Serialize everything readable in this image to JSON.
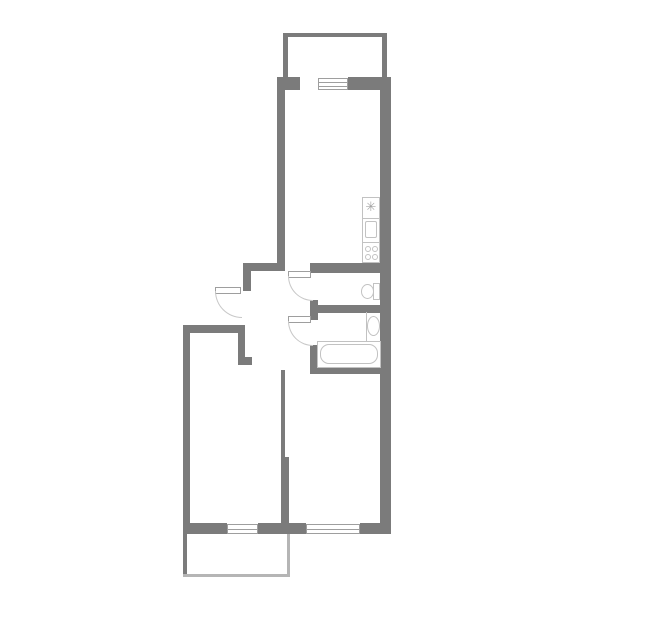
{
  "title": "apartment-floor-plan",
  "canvas": {
    "width": 645,
    "height": 635,
    "background": "#ffffff"
  },
  "colors": {
    "wall": "#7b7b7b",
    "wall_light": "#b5b5b5",
    "window_border": "#9e9e9e",
    "leaf_border": "#9e9e9e",
    "arc": "#c8c8c8",
    "fixture": "#c2c2c2",
    "glyph": "#a5a5a5",
    "background": "#ffffff"
  },
  "rooms": [
    {
      "name": "upper-balcony"
    },
    {
      "name": "kitchen"
    },
    {
      "name": "hallway"
    },
    {
      "name": "wc"
    },
    {
      "name": "bathroom"
    },
    {
      "name": "bedroom"
    },
    {
      "name": "living-room"
    },
    {
      "name": "lower-balcony"
    }
  ],
  "elements": [
    {
      "type": "wall",
      "name": "upper-balcony-top-wall",
      "x": 283,
      "y": 33,
      "w": 104,
      "h": 4
    },
    {
      "type": "wall",
      "name": "upper-balcony-left-wall",
      "x": 283,
      "y": 37,
      "w": 5,
      "h": 40
    },
    {
      "type": "wall",
      "name": "upper-balcony-right-wall",
      "x": 382,
      "y": 37,
      "w": 5,
      "h": 40
    },
    {
      "type": "wall",
      "name": "facade-wall-left-stub",
      "x": 277,
      "y": 77,
      "w": 23,
      "h": 13
    },
    {
      "type": "wall",
      "name": "facade-wall-right",
      "x": 348,
      "y": 77,
      "w": 43,
      "h": 13
    },
    {
      "type": "wall",
      "name": "kitchen-left-wall",
      "x": 277,
      "y": 77,
      "w": 8,
      "h": 194
    },
    {
      "type": "wall",
      "name": "right-outer-wall",
      "x": 380,
      "y": 77,
      "w": 11,
      "h": 457
    },
    {
      "type": "wall",
      "name": "kitchen-bottom-wall",
      "x": 243,
      "y": 263,
      "w": 42,
      "h": 8
    },
    {
      "type": "wall",
      "name": "wc-top-wall",
      "x": 310,
      "y": 263,
      "w": 81,
      "h": 10
    },
    {
      "type": "wall",
      "name": "entry-side-wall",
      "x": 243,
      "y": 263,
      "w": 8,
      "h": 28
    },
    {
      "type": "wall",
      "name": "bedroom-top-wall",
      "x": 183,
      "y": 325,
      "w": 62,
      "h": 8
    },
    {
      "type": "wall",
      "name": "bedroom-doorway-stub",
      "x": 238,
      "y": 333,
      "w": 7,
      "h": 32
    },
    {
      "type": "wall",
      "name": "bedroom-doorway-foot",
      "x": 238,
      "y": 357,
      "w": 14,
      "h": 8
    },
    {
      "type": "wall",
      "name": "bedroom-left-wall",
      "x": 183,
      "y": 325,
      "w": 7,
      "h": 209
    },
    {
      "type": "wall",
      "name": "wc-bath-partition-cap",
      "x": 310,
      "y": 300,
      "w": 8,
      "h": 20
    },
    {
      "type": "wall",
      "name": "wc-bath-partition",
      "x": 310,
      "y": 305,
      "w": 81,
      "h": 8
    },
    {
      "type": "wall",
      "name": "bathroom-left-wall",
      "x": 310,
      "y": 345,
      "w": 8,
      "h": 29
    },
    {
      "type": "wall",
      "name": "bathroom-bottom-wall",
      "x": 310,
      "y": 366,
      "w": 81,
      "h": 8
    },
    {
      "type": "wall",
      "name": "living-room-left-wall-upper",
      "x": 281,
      "y": 370,
      "w": 4,
      "h": 87
    },
    {
      "type": "wall",
      "name": "living-room-left-wall-lower",
      "x": 281,
      "y": 457,
      "w": 8,
      "h": 77
    },
    {
      "type": "wall",
      "name": "bottom-wall-left",
      "x": 183,
      "y": 523,
      "w": 44,
      "h": 11
    },
    {
      "type": "wall",
      "name": "bottom-wall-center",
      "x": 258,
      "y": 523,
      "w": 48,
      "h": 11
    },
    {
      "type": "wall",
      "name": "bottom-wall-right",
      "x": 360,
      "y": 523,
      "w": 31,
      "h": 11
    },
    {
      "type": "wall",
      "name": "lower-balcony-left-wall",
      "x": 183,
      "y": 534,
      "w": 4,
      "h": 42
    },
    {
      "type": "wall",
      "name": "lower-balcony-bottom-wall",
      "x": 183,
      "y": 574,
      "w": 107,
      "h": 3,
      "color": "wall_light"
    },
    {
      "type": "wall",
      "name": "lower-balcony-right-wall",
      "x": 287,
      "y": 534,
      "w": 3,
      "h": 43,
      "color": "wall_light"
    },
    {
      "type": "window",
      "name": "kitchen-window",
      "x": 318,
      "y": 78,
      "w": 30,
      "h": 12,
      "lines": 2
    },
    {
      "type": "window",
      "name": "bedroom-window",
      "x": 227,
      "y": 524,
      "w": 31,
      "h": 10,
      "lines": 1
    },
    {
      "type": "window",
      "name": "living-room-window",
      "x": 306,
      "y": 524,
      "w": 54,
      "h": 10,
      "lines": 1
    },
    {
      "type": "leaf",
      "name": "entry-door-leaf",
      "x": 215,
      "y": 287,
      "w": 26,
      "h": 7
    },
    {
      "type": "arc",
      "name": "entry-door-arc",
      "x": 215,
      "y": 291,
      "w": 27,
      "h": 27
    },
    {
      "type": "leaf",
      "name": "wc-door-leaf",
      "x": 288,
      "y": 271,
      "w": 23,
      "h": 7
    },
    {
      "type": "arc",
      "name": "wc-door-arc",
      "x": 288,
      "y": 276,
      "w": 25,
      "h": 25
    },
    {
      "type": "leaf",
      "name": "bathroom-door-leaf",
      "x": 288,
      "y": 316,
      "w": 23,
      "h": 7
    },
    {
      "type": "arc",
      "name": "bathroom-door-arc",
      "x": 288,
      "y": 321,
      "w": 25,
      "h": 25
    },
    {
      "type": "outline",
      "name": "kitchen-counter",
      "x": 362,
      "y": 197,
      "w": 18,
      "h": 66
    },
    {
      "type": "fill",
      "name": "counter-divider-top",
      "x": 362,
      "y": 218,
      "w": 18,
      "h": 1
    },
    {
      "type": "fill",
      "name": "counter-divider-bottom",
      "x": 362,
      "y": 242,
      "w": 18,
      "h": 1
    },
    {
      "type": "glyph",
      "name": "fridge-icon",
      "x": 362,
      "y": 200,
      "w": 18,
      "h": 15,
      "char": "✳",
      "size": 13
    },
    {
      "type": "outline",
      "name": "kitchen-sink",
      "x": 365,
      "y": 221,
      "w": 12,
      "h": 17,
      "r": 2
    },
    {
      "type": "ellipse",
      "name": "stove-burner-1",
      "x": 365,
      "y": 246,
      "w": 6,
      "h": 6
    },
    {
      "type": "ellipse",
      "name": "stove-burner-2",
      "x": 372,
      "y": 246,
      "w": 6,
      "h": 6
    },
    {
      "type": "ellipse",
      "name": "stove-burner-3",
      "x": 365,
      "y": 254,
      "w": 6,
      "h": 6
    },
    {
      "type": "ellipse",
      "name": "stove-burner-4",
      "x": 372,
      "y": 254,
      "w": 6,
      "h": 6
    },
    {
      "type": "outline",
      "name": "toilet-tank",
      "x": 373,
      "y": 283,
      "w": 7,
      "h": 17
    },
    {
      "type": "ellipse",
      "name": "toilet-bowl",
      "x": 361,
      "y": 284,
      "w": 13,
      "h": 15
    },
    {
      "type": "fill",
      "name": "bath-sink-counter-edge",
      "x": 366,
      "y": 312,
      "w": 1,
      "h": 29
    },
    {
      "type": "ellipse",
      "name": "bathroom-sink",
      "x": 367,
      "y": 316,
      "w": 13,
      "h": 20
    },
    {
      "type": "outline",
      "name": "bathtub-rim",
      "x": 317,
      "y": 341,
      "w": 64,
      "h": 27
    },
    {
      "type": "outline",
      "name": "bathtub-basin",
      "x": 320,
      "y": 344,
      "w": 58,
      "h": 20,
      "r": 9
    }
  ]
}
